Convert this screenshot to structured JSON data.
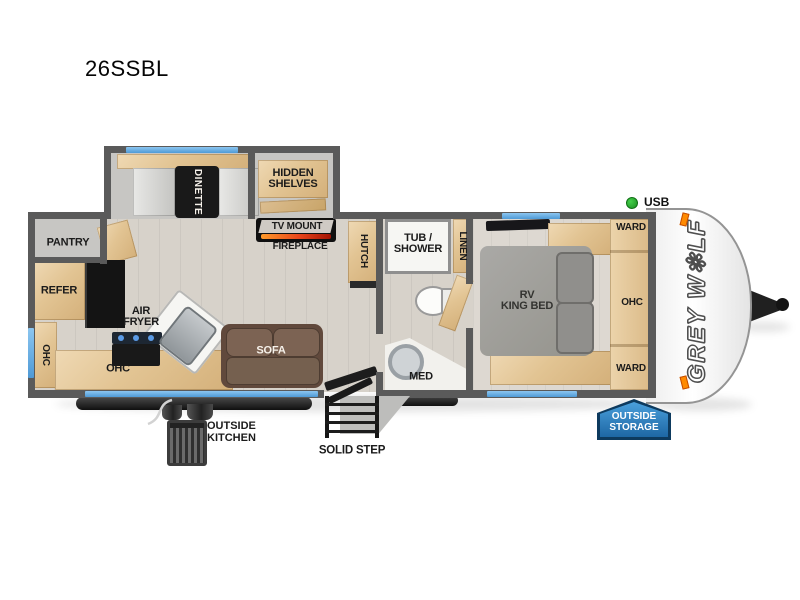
{
  "title": "26SSBL",
  "brand": {
    "name": "GREY W✻LF"
  },
  "indicators": {
    "usb": "USB"
  },
  "colors": {
    "window_accent": "#5ba7e2",
    "storage_badge": "#2f84c4",
    "usb_indicator": "#23a428",
    "fireplace_glow": "#ff7a1f",
    "wall": "#5a5a5a",
    "wood_cabinet": "#e2c493"
  },
  "labels": {
    "pantry": "PANTRY",
    "refer": "REFER",
    "ohc_rear": "OHC",
    "air_fryer_l1": "AIR",
    "air_fryer_l2": "FRYER",
    "ohc_kitchen": "OHC",
    "dinette": "DINETTE",
    "hidden_shelves_l1": "HIDDEN",
    "hidden_shelves_l2": "SHELVES",
    "tv_mount": "TV MOUNT",
    "fireplace": "FIREPLACE",
    "sofa": "SOFA",
    "hutch": "HUTCH",
    "tub_shower_l1": "TUB /",
    "tub_shower_l2": "SHOWER",
    "linen": "LINEN",
    "med": "MED",
    "bed_l1": "RV",
    "bed_l2": "KING BED",
    "ward_top": "WARD",
    "ohc_bed": "OHC",
    "ward_bottom": "WARD"
  },
  "callouts": {
    "outside_kitchen_l1": "OUTSIDE",
    "outside_kitchen_l2": "KITCHEN",
    "solid_step": "SOLID STEP",
    "outside_storage_l1": "OUTSIDE",
    "outside_storage_l2": "STORAGE"
  }
}
